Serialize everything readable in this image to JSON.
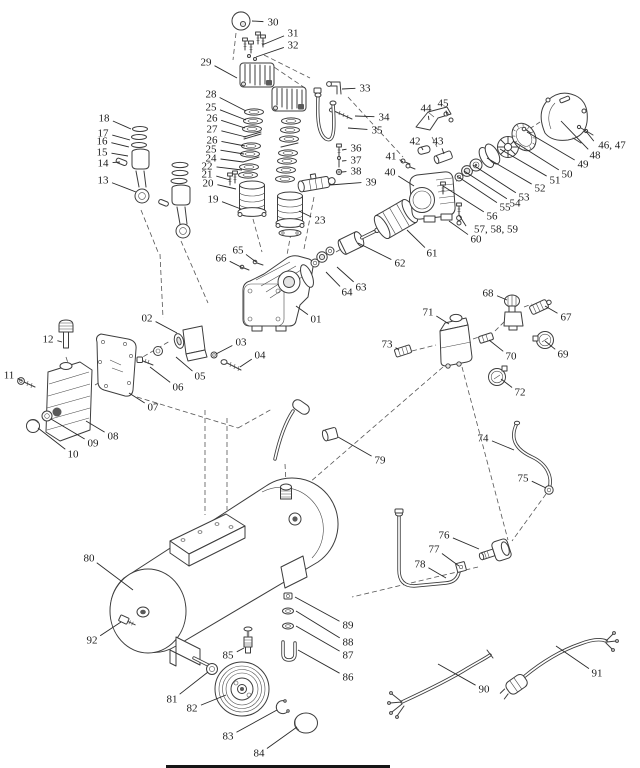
{
  "style": {
    "background": "#ffffff",
    "line_color": "#3d3d3d",
    "label_color": "#1c1c1c"
  },
  "labels": [
    {
      "t": "30",
      "x": 273,
      "y": 22,
      "tx": 252,
      "ty": 21
    },
    {
      "t": "31",
      "x": 293,
      "y": 33,
      "tx": 262,
      "ty": 45
    },
    {
      "t": "32",
      "x": 293,
      "y": 45,
      "tx": 256,
      "ty": 57
    },
    {
      "t": "29",
      "x": 206,
      "y": 62,
      "tx": 237,
      "ty": 78
    },
    {
      "t": "33",
      "x": 365,
      "y": 88,
      "tx": 342,
      "ty": 89
    },
    {
      "t": "34",
      "x": 384,
      "y": 117,
      "tx": 355,
      "ty": 116
    },
    {
      "t": "35",
      "x": 377,
      "y": 130,
      "tx": 348,
      "ty": 128
    },
    {
      "t": "28",
      "x": 211,
      "y": 94,
      "tx": 246,
      "ty": 111
    },
    {
      "t": "25",
      "x": 211,
      "y": 107,
      "tx": 246,
      "ty": 120
    },
    {
      "t": "26",
      "x": 212,
      "y": 118,
      "tx": 245,
      "ty": 128
    },
    {
      "t": "27",
      "x": 212,
      "y": 129,
      "tx": 246,
      "ty": 137
    },
    {
      "t": "26",
      "x": 212,
      "y": 140,
      "tx": 245,
      "ty": 146
    },
    {
      "t": "25",
      "x": 211,
      "y": 149,
      "tx": 244,
      "ty": 154
    },
    {
      "t": "24",
      "x": 211,
      "y": 158,
      "tx": 243,
      "ty": 162
    },
    {
      "t": "22",
      "x": 207,
      "y": 166,
      "tx": 242,
      "ty": 170
    },
    {
      "t": "21",
      "x": 207,
      "y": 174,
      "tx": 230,
      "ty": 180
    },
    {
      "t": "20",
      "x": 208,
      "y": 183,
      "tx": 236,
      "ty": 189
    },
    {
      "t": "19",
      "x": 213,
      "y": 199,
      "tx": 241,
      "ty": 209
    },
    {
      "t": "23",
      "x": 320,
      "y": 220,
      "tx": 299,
      "ty": 211
    },
    {
      "t": "36",
      "x": 356,
      "y": 148,
      "tx": 342,
      "ty": 150
    },
    {
      "t": "37",
      "x": 356,
      "y": 160,
      "tx": 342,
      "ty": 161
    },
    {
      "t": "38",
      "x": 356,
      "y": 171,
      "tx": 342,
      "ty": 172
    },
    {
      "t": "39",
      "x": 371,
      "y": 182,
      "tx": 330,
      "ty": 185
    },
    {
      "t": "18",
      "x": 104,
      "y": 118,
      "tx": 131,
      "ty": 129
    },
    {
      "t": "17",
      "x": 103,
      "y": 133,
      "tx": 130,
      "ty": 140
    },
    {
      "t": "16",
      "x": 102,
      "y": 141,
      "tx": 129,
      "ty": 147
    },
    {
      "t": "15",
      "x": 102,
      "y": 152,
      "tx": 128,
      "ty": 156
    },
    {
      "t": "14",
      "x": 103,
      "y": 163,
      "tx": 120,
      "ty": 162
    },
    {
      "t": "13",
      "x": 103,
      "y": 180,
      "tx": 136,
      "ty": 192
    },
    {
      "t": "44",
      "x": 426,
      "y": 108,
      "tx": 429,
      "ty": 120
    },
    {
      "t": "45",
      "x": 443,
      "y": 103,
      "tx": 447,
      "ty": 115
    },
    {
      "t": "42",
      "x": 415,
      "y": 141,
      "tx": 423,
      "ty": 150
    },
    {
      "t": "43",
      "x": 438,
      "y": 141,
      "tx": 444,
      "ty": 154
    },
    {
      "t": "41",
      "x": 391,
      "y": 156,
      "tx": 403,
      "ty": 162
    },
    {
      "t": "40",
      "x": 390,
      "y": 172,
      "tx": 414,
      "ty": 186
    },
    {
      "t": "46, 47",
      "x": 612,
      "y": 145,
      "tx": 585,
      "ty": 130
    },
    {
      "t": "48",
      "x": 595,
      "y": 155,
      "tx": 561,
      "ty": 121
    },
    {
      "t": "49",
      "x": 583,
      "y": 164,
      "tx": 527,
      "ty": 132
    },
    {
      "t": "50",
      "x": 567,
      "y": 174,
      "tx": 513,
      "ty": 141
    },
    {
      "t": "51",
      "x": 555,
      "y": 180,
      "tx": 500,
      "ty": 149
    },
    {
      "t": "52",
      "x": 540,
      "y": 188,
      "tx": 487,
      "ty": 158
    },
    {
      "t": "53",
      "x": 524,
      "y": 197,
      "tx": 473,
      "ty": 165
    },
    {
      "t": "54",
      "x": 515,
      "y": 203,
      "tx": 464,
      "ty": 171
    },
    {
      "t": "55",
      "x": 505,
      "y": 207,
      "tx": 457,
      "ty": 176
    },
    {
      "t": "56",
      "x": 492,
      "y": 216,
      "tx": 443,
      "ty": 186
    },
    {
      "t": "57, 58, 59",
      "x": 496,
      "y": 229,
      "tx": 459,
      "ty": 215
    },
    {
      "t": "60",
      "x": 476,
      "y": 239,
      "tx": 449,
      "ty": 221
    },
    {
      "t": "61",
      "x": 432,
      "y": 253,
      "tx": 407,
      "ty": 230
    },
    {
      "t": "62",
      "x": 400,
      "y": 263,
      "tx": 358,
      "ty": 243
    },
    {
      "t": "63",
      "x": 361,
      "y": 287,
      "tx": 337,
      "ty": 267
    },
    {
      "t": "64",
      "x": 347,
      "y": 292,
      "tx": 326,
      "ty": 272
    },
    {
      "t": "65",
      "x": 238,
      "y": 250,
      "tx": 256,
      "ty": 262
    },
    {
      "t": "66",
      "x": 221,
      "y": 258,
      "tx": 243,
      "ty": 268
    },
    {
      "t": "01",
      "x": 316,
      "y": 319,
      "tx": 296,
      "ty": 306
    },
    {
      "t": "02",
      "x": 147,
      "y": 318,
      "tx": 177,
      "ty": 333
    },
    {
      "t": "03",
      "x": 241,
      "y": 342,
      "tx": 216,
      "ty": 354
    },
    {
      "t": "04",
      "x": 260,
      "y": 355,
      "tx": 240,
      "ty": 367
    },
    {
      "t": "05",
      "x": 200,
      "y": 376,
      "tx": 176,
      "ty": 357
    },
    {
      "t": "06",
      "x": 178,
      "y": 387,
      "tx": 150,
      "ty": 367
    },
    {
      "t": "07",
      "x": 153,
      "y": 407,
      "tx": 129,
      "ty": 393
    },
    {
      "t": "12",
      "x": 48,
      "y": 339,
      "tx": 62,
      "ty": 342
    },
    {
      "t": "11",
      "x": 9,
      "y": 375,
      "tx": 22,
      "ty": 381
    },
    {
      "t": "08",
      "x": 113,
      "y": 436,
      "tx": 86,
      "ty": 421
    },
    {
      "t": "09",
      "x": 93,
      "y": 443,
      "tx": 51,
      "ty": 419
    },
    {
      "t": "10",
      "x": 73,
      "y": 454,
      "tx": 38,
      "ty": 428
    },
    {
      "t": "68",
      "x": 488,
      "y": 293,
      "tx": 507,
      "ty": 300
    },
    {
      "t": "67",
      "x": 566,
      "y": 317,
      "tx": 545,
      "ty": 306
    },
    {
      "t": "71",
      "x": 428,
      "y": 312,
      "tx": 449,
      "ty": 324
    },
    {
      "t": "73",
      "x": 387,
      "y": 344,
      "tx": 399,
      "ty": 350
    },
    {
      "t": "70",
      "x": 511,
      "y": 356,
      "tx": 489,
      "ty": 340
    },
    {
      "t": "69",
      "x": 563,
      "y": 354,
      "tx": 545,
      "ty": 341
    },
    {
      "t": "72",
      "x": 520,
      "y": 392,
      "tx": 501,
      "ty": 379
    },
    {
      "t": "79",
      "x": 380,
      "y": 460,
      "tx": 338,
      "ty": 437
    },
    {
      "t": "74",
      "x": 483,
      "y": 438,
      "tx": 514,
      "ty": 450
    },
    {
      "t": "75",
      "x": 523,
      "y": 478,
      "tx": 546,
      "ty": 488
    },
    {
      "t": "76",
      "x": 444,
      "y": 535,
      "tx": 479,
      "ty": 549
    },
    {
      "t": "77",
      "x": 434,
      "y": 549,
      "tx": 459,
      "ty": 566
    },
    {
      "t": "78",
      "x": 420,
      "y": 564,
      "tx": 446,
      "ty": 578
    },
    {
      "t": "80",
      "x": 89,
      "y": 558,
      "tx": 133,
      "ty": 590
    },
    {
      "t": "92",
      "x": 92,
      "y": 640,
      "tx": 121,
      "ty": 622
    },
    {
      "t": "85",
      "x": 228,
      "y": 655,
      "tx": 244,
      "ty": 648
    },
    {
      "t": "89",
      "x": 348,
      "y": 625,
      "tx": 295,
      "ty": 597
    },
    {
      "t": "88",
      "x": 348,
      "y": 642,
      "tx": 296,
      "ty": 611
    },
    {
      "t": "87",
      "x": 348,
      "y": 655,
      "tx": 296,
      "ty": 626
    },
    {
      "t": "86",
      "x": 348,
      "y": 677,
      "tx": 298,
      "ty": 650
    },
    {
      "t": "81",
      "x": 172,
      "y": 699,
      "tx": 208,
      "ty": 672
    },
    {
      "t": "82",
      "x": 192,
      "y": 708,
      "tx": 226,
      "ty": 695
    },
    {
      "t": "83",
      "x": 228,
      "y": 736,
      "tx": 277,
      "ty": 710
    },
    {
      "t": "84",
      "x": 259,
      "y": 753,
      "tx": 297,
      "ty": 727
    },
    {
      "t": "90",
      "x": 484,
      "y": 689,
      "tx": 438,
      "ty": 664
    },
    {
      "t": "91",
      "x": 597,
      "y": 673,
      "tx": 556,
      "ty": 646
    }
  ]
}
